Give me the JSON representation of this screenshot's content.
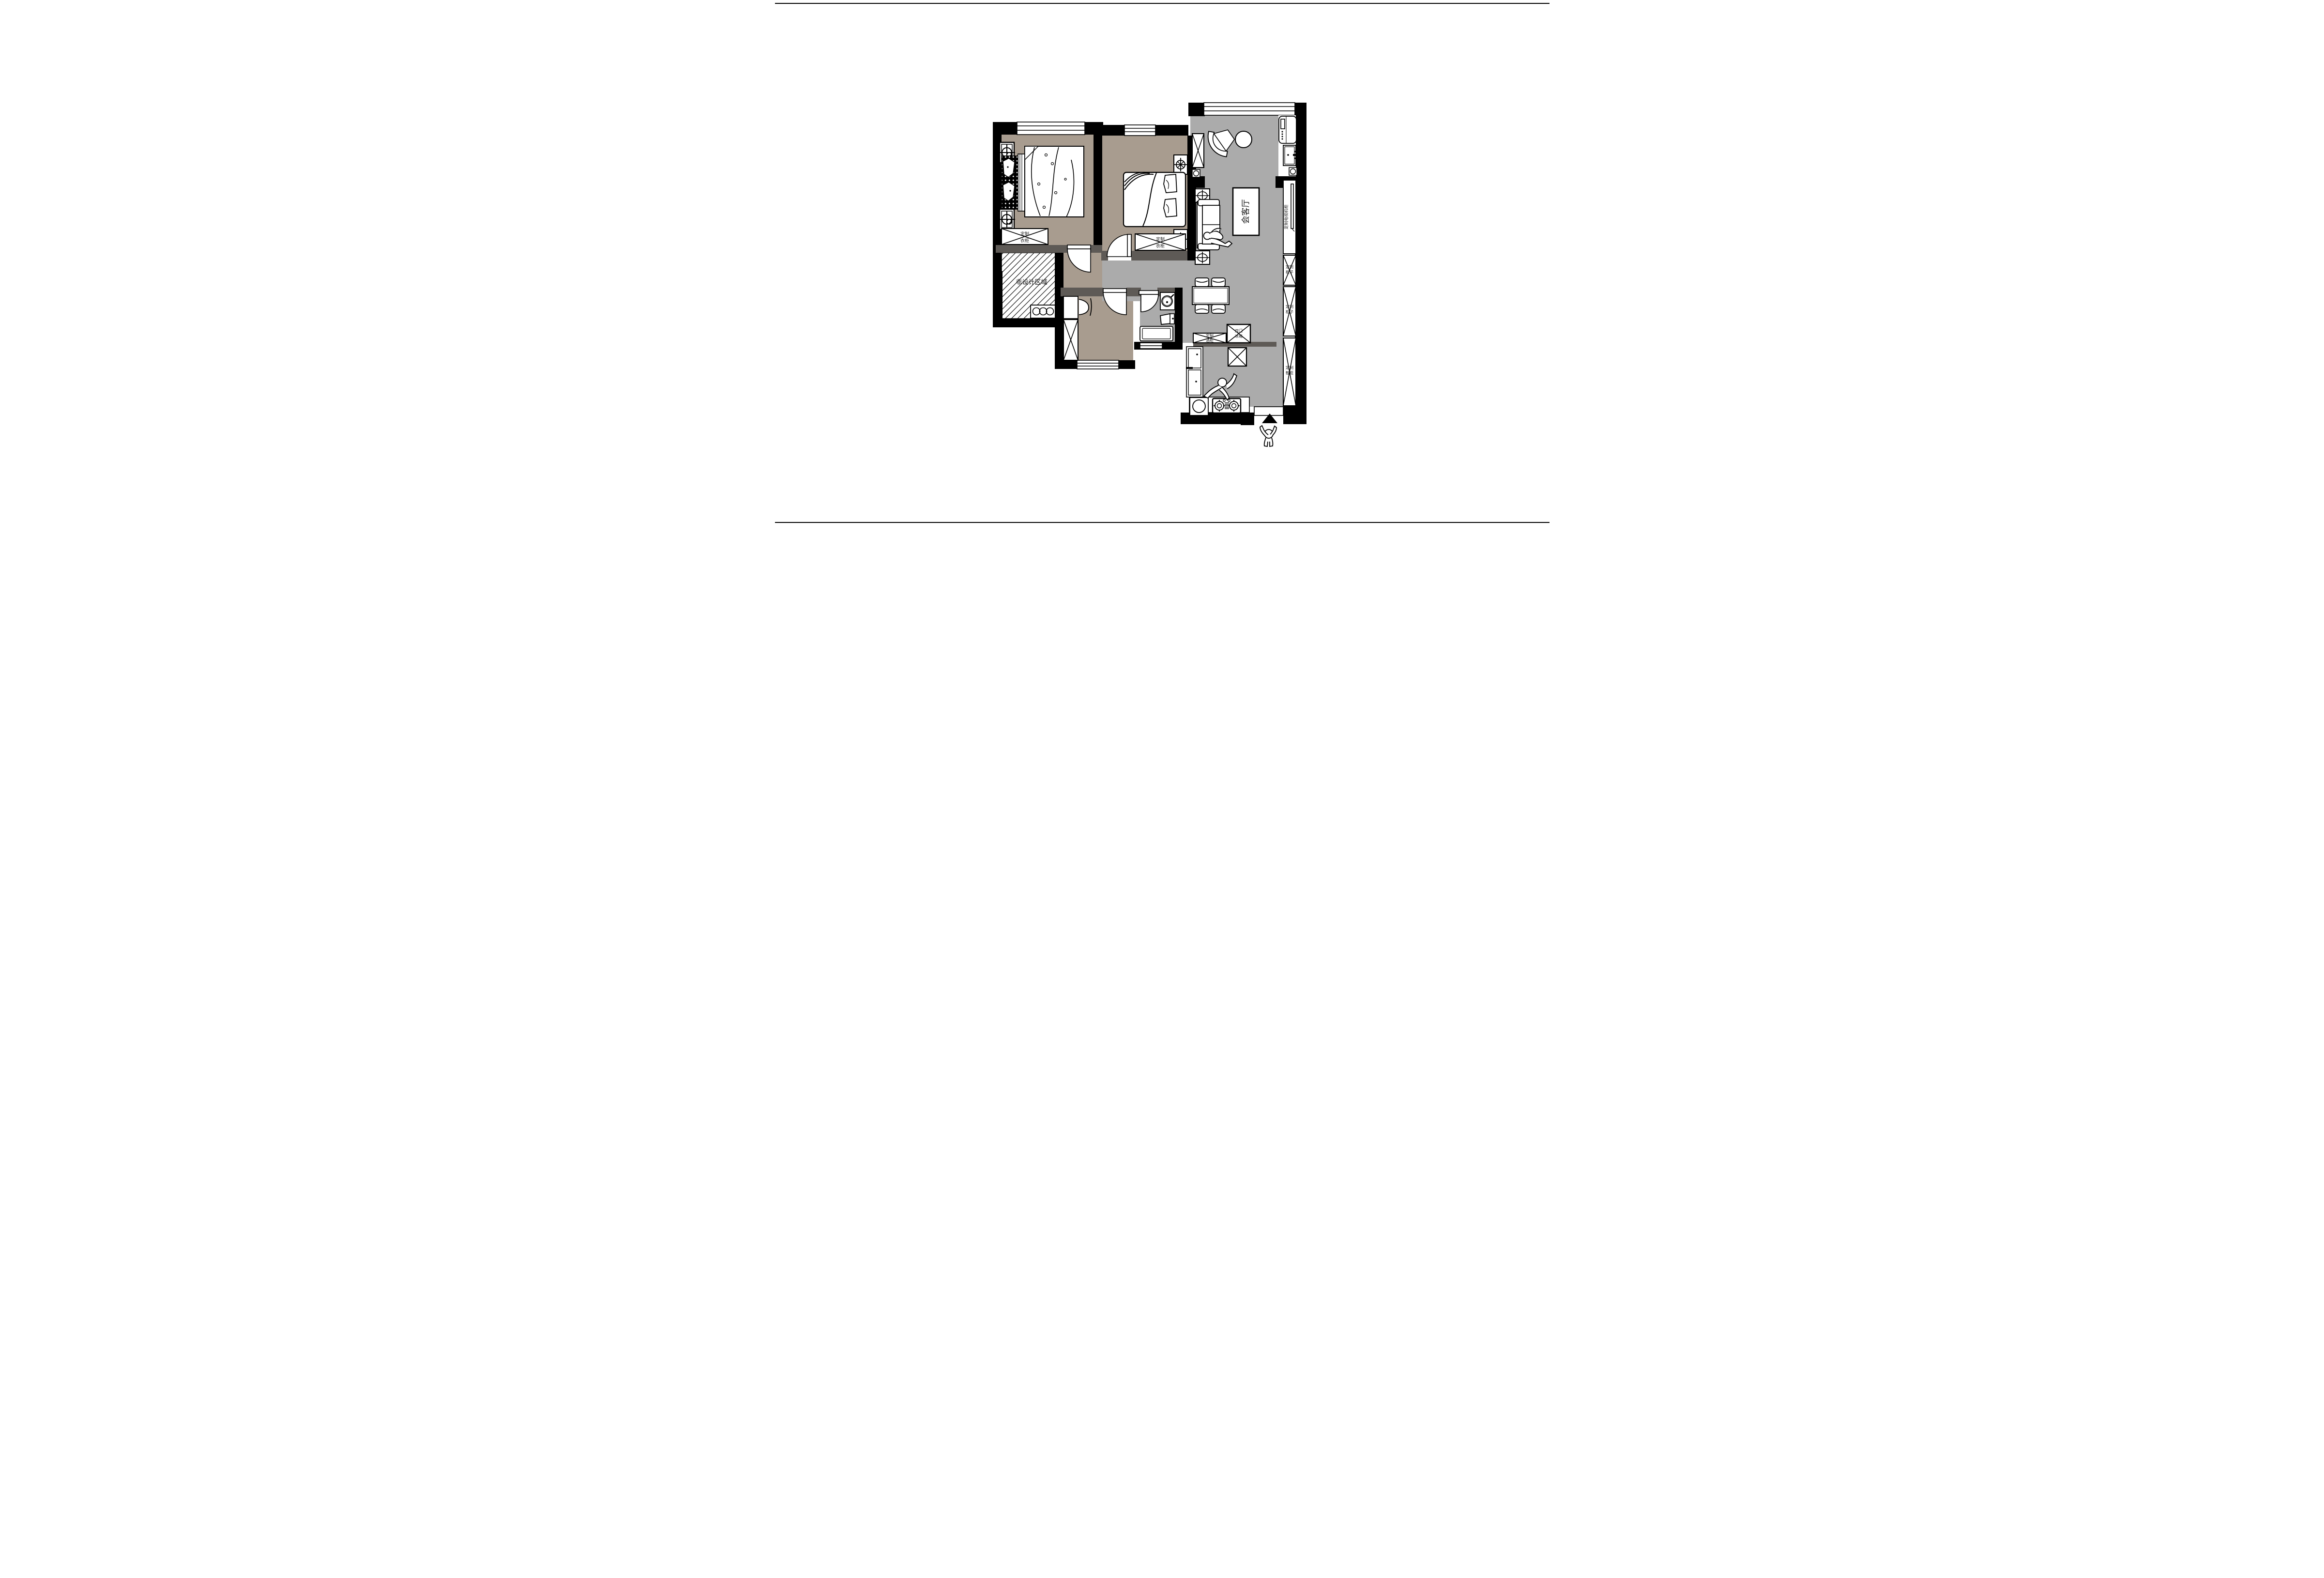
{
  "drawing": {
    "type": "residential-floor-plan",
    "orientation_marker": "entry-arrow-triangle",
    "colors": {
      "bedroom_floor": "#A89C8F",
      "public_floor": "#ABABAB",
      "partition_wall": "#5E5A56",
      "structure_wall": "#000000",
      "paper": "#FFFFFF"
    }
  },
  "labels": {
    "living_room": "会客厅",
    "non_design_area": "非设计区域",
    "custom_wardrobe_l1": "定制",
    "custom_wardrobe_l2": "衣柜",
    "tv_cabinet": "定制电视机柜",
    "custom_cabinet_l1": "定制",
    "custom_cabinet_l2": "柜子",
    "shoe_cabinet_l1": "定制",
    "shoe_cabinet_l2": "鞋柜",
    "wine_cabinet_l1": "定制",
    "wine_cabinet_l2": "酒柜",
    "fridge_l1": "双门",
    "fridge_l2": "冰箱"
  },
  "rooms": [
    {
      "name": "master-bedroom",
      "label": "",
      "floor": "#A89C8F",
      "furniture": [
        "double-bed",
        "custom-wardrobe",
        "column-marker x2"
      ]
    },
    {
      "name": "second-bedroom",
      "label": "",
      "floor": "#A89C8F",
      "furniture": [
        "double-bed",
        "custom-wardrobe",
        "nightstand-lamp x2",
        "swing-door"
      ]
    },
    {
      "name": "study",
      "label": "",
      "floor": "#A89C8F",
      "furniture": [
        "desk",
        "chair",
        "wardrobe",
        "swing-door",
        "window"
      ]
    },
    {
      "name": "bathroom",
      "label": "",
      "floor": "#ABABAB",
      "furniture": [
        "washbasin",
        "toilet",
        "bathtub",
        "swing-door",
        "window"
      ]
    },
    {
      "name": "living-room",
      "label": "会客厅",
      "floor": "#ABABAB",
      "furniture": [
        "sofa",
        "rug",
        "side-table x2",
        "tv",
        "tv-cabinet"
      ]
    },
    {
      "name": "balcony",
      "label": "",
      "floor": "#ABABAB",
      "furniture": [
        "chair",
        "round-table",
        "washing-machine",
        "cabinet"
      ]
    },
    {
      "name": "dining",
      "label": "",
      "floor": "#ABABAB",
      "furniture": [
        "table",
        "chair x4"
      ]
    },
    {
      "name": "kitchen",
      "label": "",
      "floor": "#ABABAB",
      "furniture": [
        "gas-stove",
        "sink",
        "counter",
        "wine-cabinet",
        "double-door-fridge",
        "cook-figure"
      ]
    },
    {
      "name": "non-design-area",
      "label": "非设计区域",
      "floor": "hatched",
      "furniture": [
        "three-circle-cabinet"
      ]
    },
    {
      "name": "entry",
      "label": "",
      "floor": "#ABABAB",
      "furniture": [
        "shoe-cabinet",
        "entry-arrow",
        "walking-figure"
      ]
    }
  ]
}
